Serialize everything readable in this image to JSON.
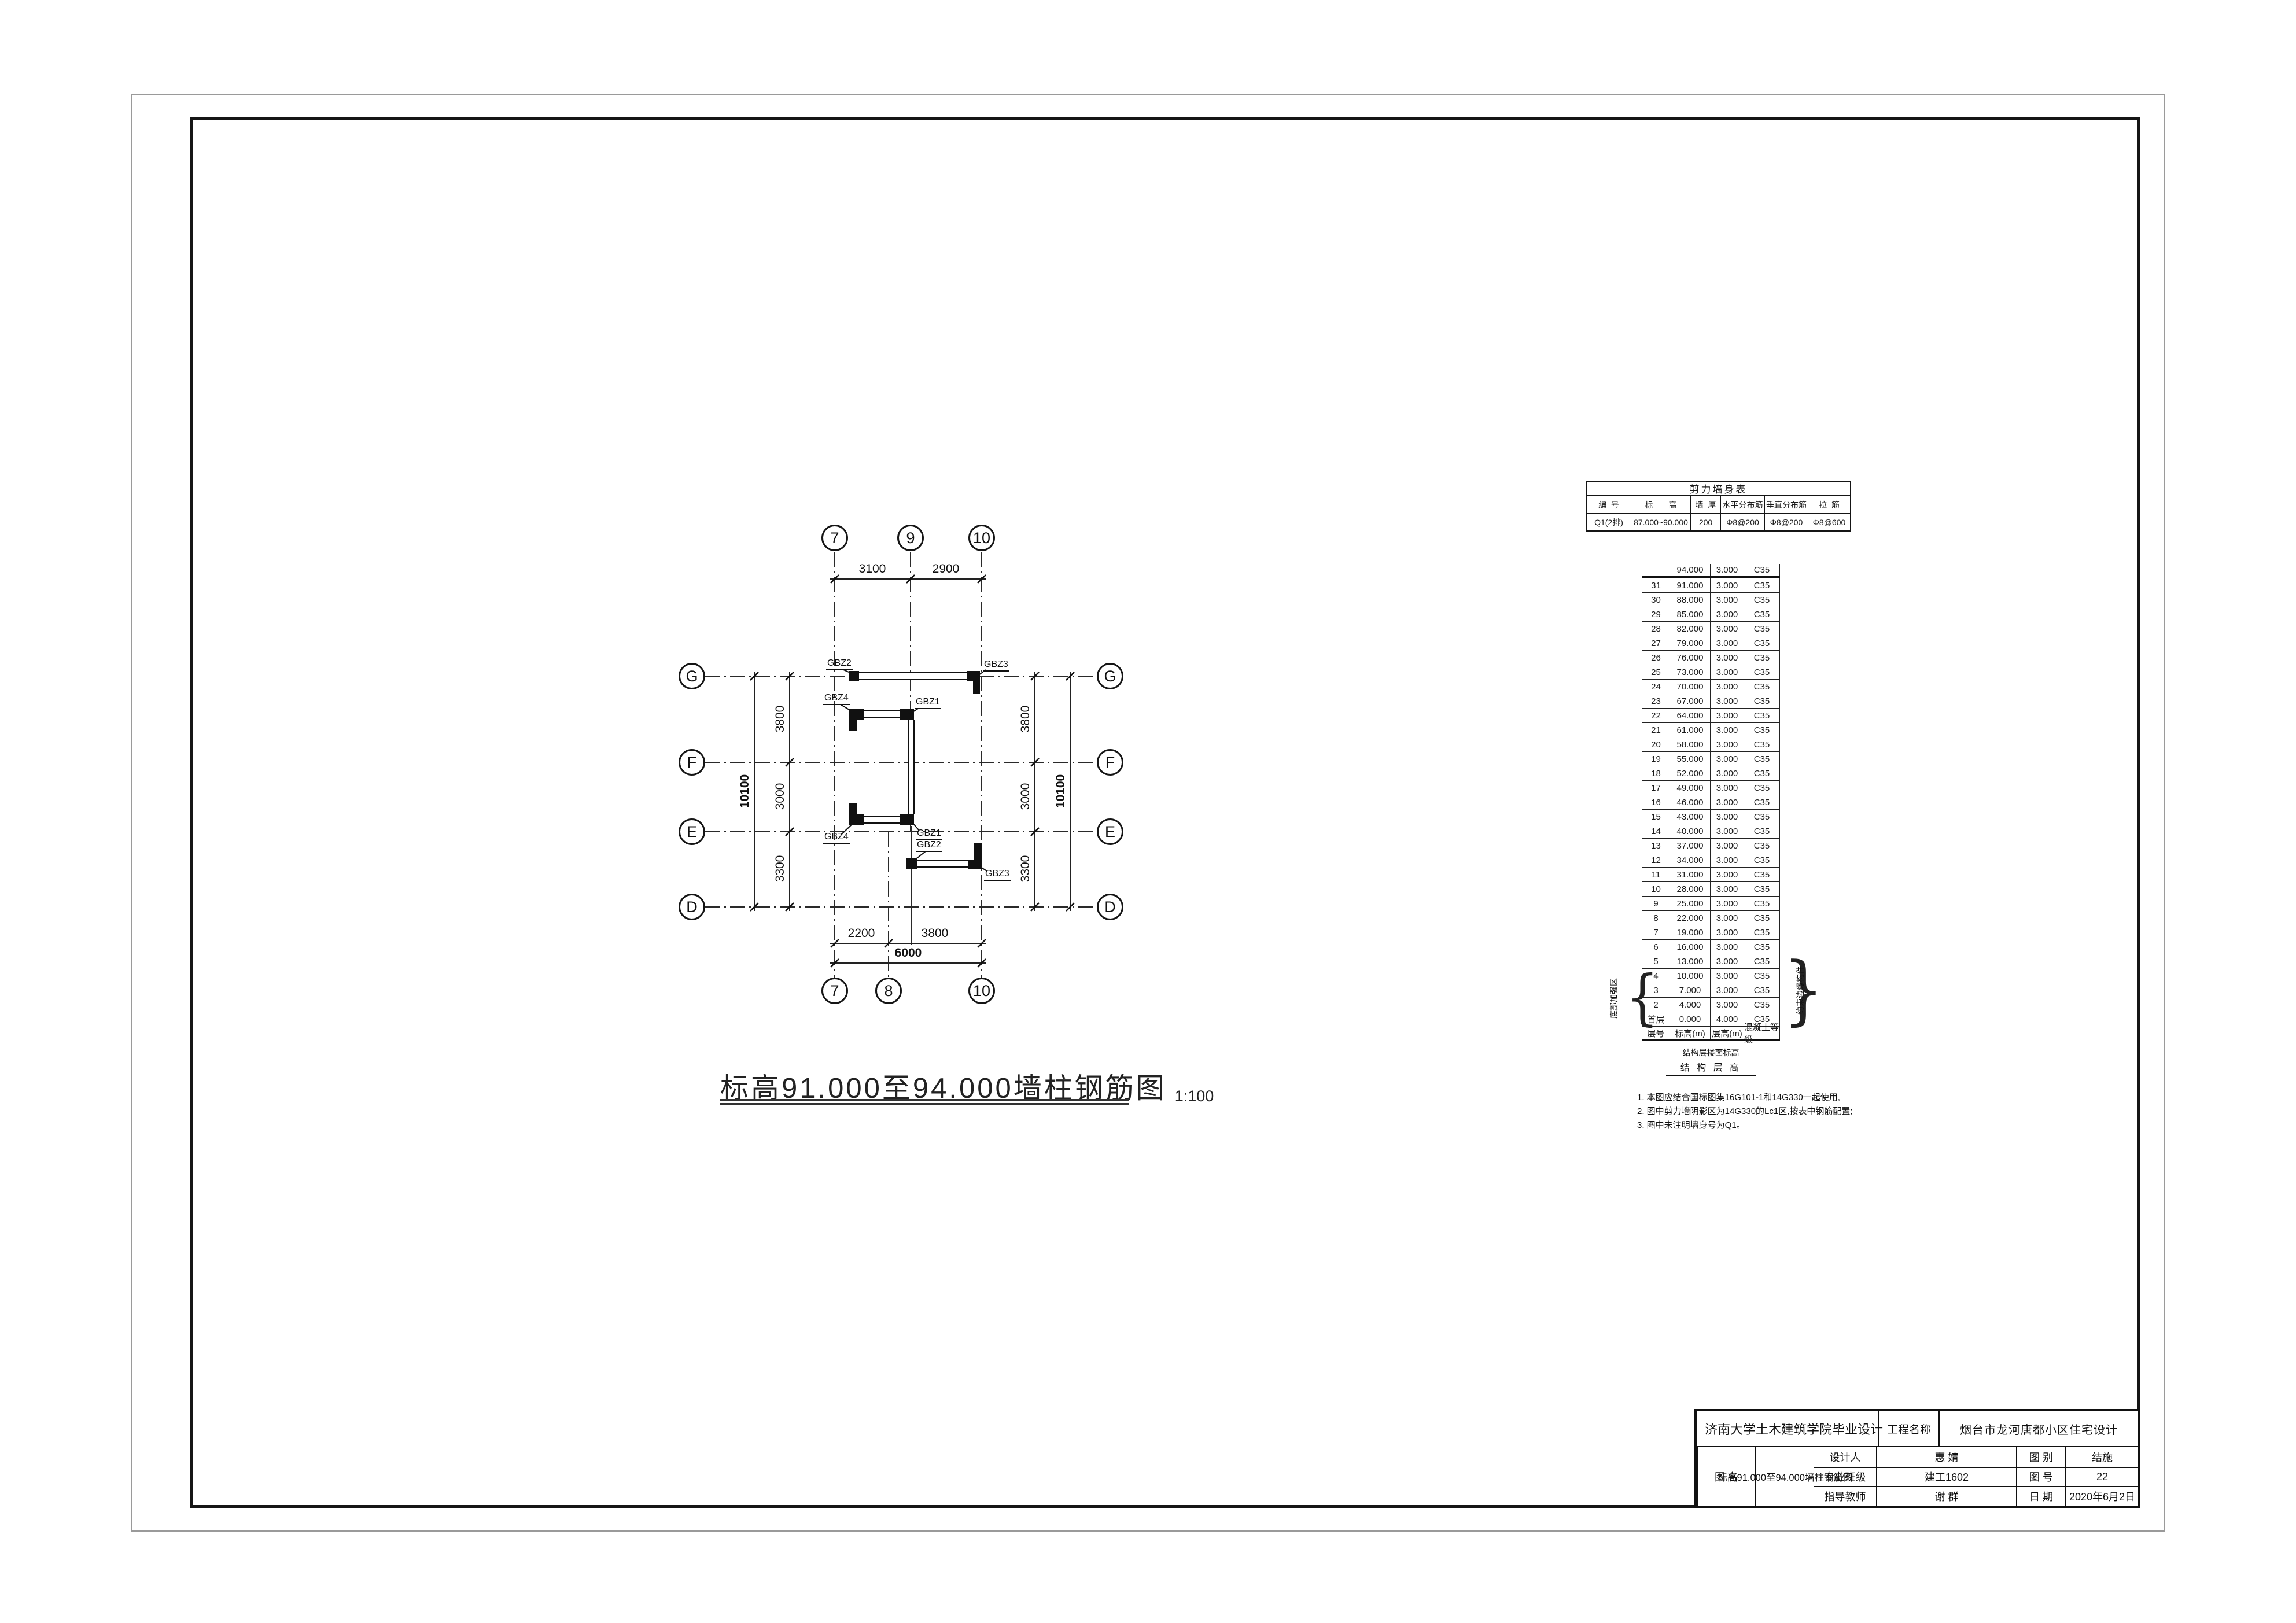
{
  "colors": {
    "line": "#1c1c1c",
    "page_border": "#9a9a9a"
  },
  "plan": {
    "title": "标高91.000至94.000墙柱钢筋图",
    "scale": "1:100",
    "grid_rows": [
      "G",
      "F",
      "E",
      "D"
    ],
    "grid_cols_top": [
      "7",
      "9",
      "10"
    ],
    "grid_cols_bottom": [
      "7",
      "8",
      "10"
    ],
    "dims_top": [
      "3100",
      "2900"
    ],
    "dims_bottom": [
      "2200",
      "3800"
    ],
    "dim_bottom_total": "6000",
    "dims_left": [
      "3800",
      "3000",
      "3300"
    ],
    "dim_left_total": "10100",
    "dims_right": [
      "3800",
      "3000",
      "3300"
    ],
    "dim_right_total": "10100",
    "labels": {
      "gbz1": "GBZ1",
      "gbz2": "GBZ2",
      "gbz3": "GBZ3",
      "gbz4": "GBZ4"
    }
  },
  "shear_wall_table": {
    "title": "剪力墙身表",
    "headers": [
      "编  号",
      "标       高",
      "墙  厚",
      "水平分布筋",
      "垂直分布筋",
      "拉  筋"
    ],
    "row": [
      "Q1(2排)",
      "87.000~90.000",
      "200",
      "Φ8@200",
      "Φ8@200",
      "Φ8@600"
    ]
  },
  "floor_table": {
    "headers": [
      "层号",
      "标高(m)",
      "层高(m)",
      "混凝土等级"
    ],
    "rows": [
      [
        "",
        "94.000",
        "3.000",
        "C35"
      ],
      [
        "31",
        "91.000",
        "3.000",
        "C35"
      ],
      [
        "30",
        "88.000",
        "3.000",
        "C35"
      ],
      [
        "29",
        "85.000",
        "3.000",
        "C35"
      ],
      [
        "28",
        "82.000",
        "3.000",
        "C35"
      ],
      [
        "27",
        "79.000",
        "3.000",
        "C35"
      ],
      [
        "26",
        "76.000",
        "3.000",
        "C35"
      ],
      [
        "25",
        "73.000",
        "3.000",
        "C35"
      ],
      [
        "24",
        "70.000",
        "3.000",
        "C35"
      ],
      [
        "23",
        "67.000",
        "3.000",
        "C35"
      ],
      [
        "22",
        "64.000",
        "3.000",
        "C35"
      ],
      [
        "21",
        "61.000",
        "3.000",
        "C35"
      ],
      [
        "20",
        "58.000",
        "3.000",
        "C35"
      ],
      [
        "19",
        "55.000",
        "3.000",
        "C35"
      ],
      [
        "18",
        "52.000",
        "3.000",
        "C35"
      ],
      [
        "17",
        "49.000",
        "3.000",
        "C35"
      ],
      [
        "16",
        "46.000",
        "3.000",
        "C35"
      ],
      [
        "15",
        "43.000",
        "3.000",
        "C35"
      ],
      [
        "14",
        "40.000",
        "3.000",
        "C35"
      ],
      [
        "13",
        "37.000",
        "3.000",
        "C35"
      ],
      [
        "12",
        "34.000",
        "3.000",
        "C35"
      ],
      [
        "11",
        "31.000",
        "3.000",
        "C35"
      ],
      [
        "10",
        "28.000",
        "3.000",
        "C35"
      ],
      [
        "9",
        "25.000",
        "3.000",
        "C35"
      ],
      [
        "8",
        "22.000",
        "3.000",
        "C35"
      ],
      [
        "7",
        "19.000",
        "3.000",
        "C35"
      ],
      [
        "6",
        "16.000",
        "3.000",
        "C35"
      ],
      [
        "5",
        "13.000",
        "3.000",
        "C35"
      ],
      [
        "4",
        "10.000",
        "3.000",
        "C35"
      ],
      [
        "3",
        "7.000",
        "3.000",
        "C35"
      ],
      [
        "2",
        "4.000",
        "3.000",
        "C35"
      ],
      [
        "首层",
        "0.000",
        "4.000",
        "C35"
      ]
    ],
    "footer_line1": "结构层楼面标高",
    "footer_line2": "结 构 层 高",
    "brace_left_label": "底部加强区",
    "brace_right_label": "约束边缘构件"
  },
  "notes": {
    "n1": "1. 本图应结合国标图集16G101-1和14G330一起使用,",
    "n2": "2. 图中剪力墙阴影区为14G330的Lc1区,按表中钢筋配置;",
    "n3": "3. 图中未注明墙身号为Q1。"
  },
  "title_block": {
    "school": "济南大学土木建筑学院毕业设计",
    "project_label": "工程名称",
    "project_name": "烟台市龙河唐都小区住宅设计",
    "designer_label": "设计人",
    "designer": "惠 婧",
    "class_label": "专业班级",
    "class_value": "建工1602",
    "advisor_label": "指导教师",
    "advisor": "谢 群",
    "drawing_name_label": "图  名",
    "drawing_name": "标高91.000至94.000墙柱钢筋图",
    "category_label": "图  别",
    "category": "结施",
    "number_label": "图  号",
    "number": "22",
    "date_label": "日  期",
    "date": "2020年6月2日"
  }
}
